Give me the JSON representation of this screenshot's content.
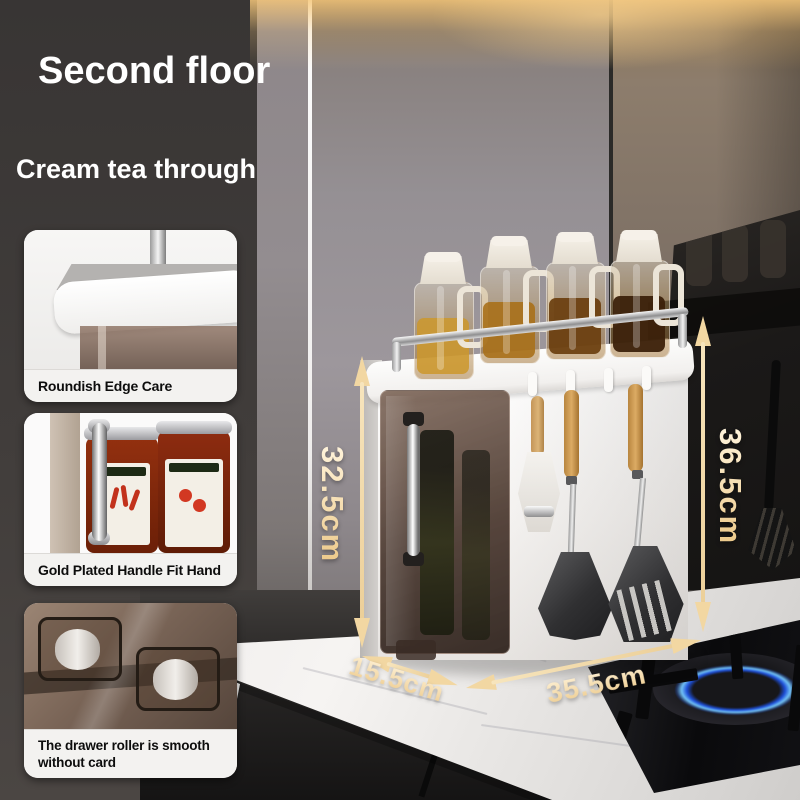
{
  "header": {
    "title": "Second floor",
    "subtitle": "Cream tea through"
  },
  "features": [
    {
      "caption": "Roundish Edge Care"
    },
    {
      "caption": "Gold Plated Handle Fit Hand"
    },
    {
      "caption": "The drawer roller is smooth without card"
    }
  ],
  "dimensions": {
    "front_height": "32.5cm",
    "back_height": "36.5cm",
    "depth": "15.5cm",
    "width": "35.5cm"
  },
  "colors": {
    "accent_gold": "#f2d7a2",
    "flame_blue": "#72c2f6",
    "wall_dark": "#3f3b39",
    "counter_white": "#f4f2f0"
  }
}
